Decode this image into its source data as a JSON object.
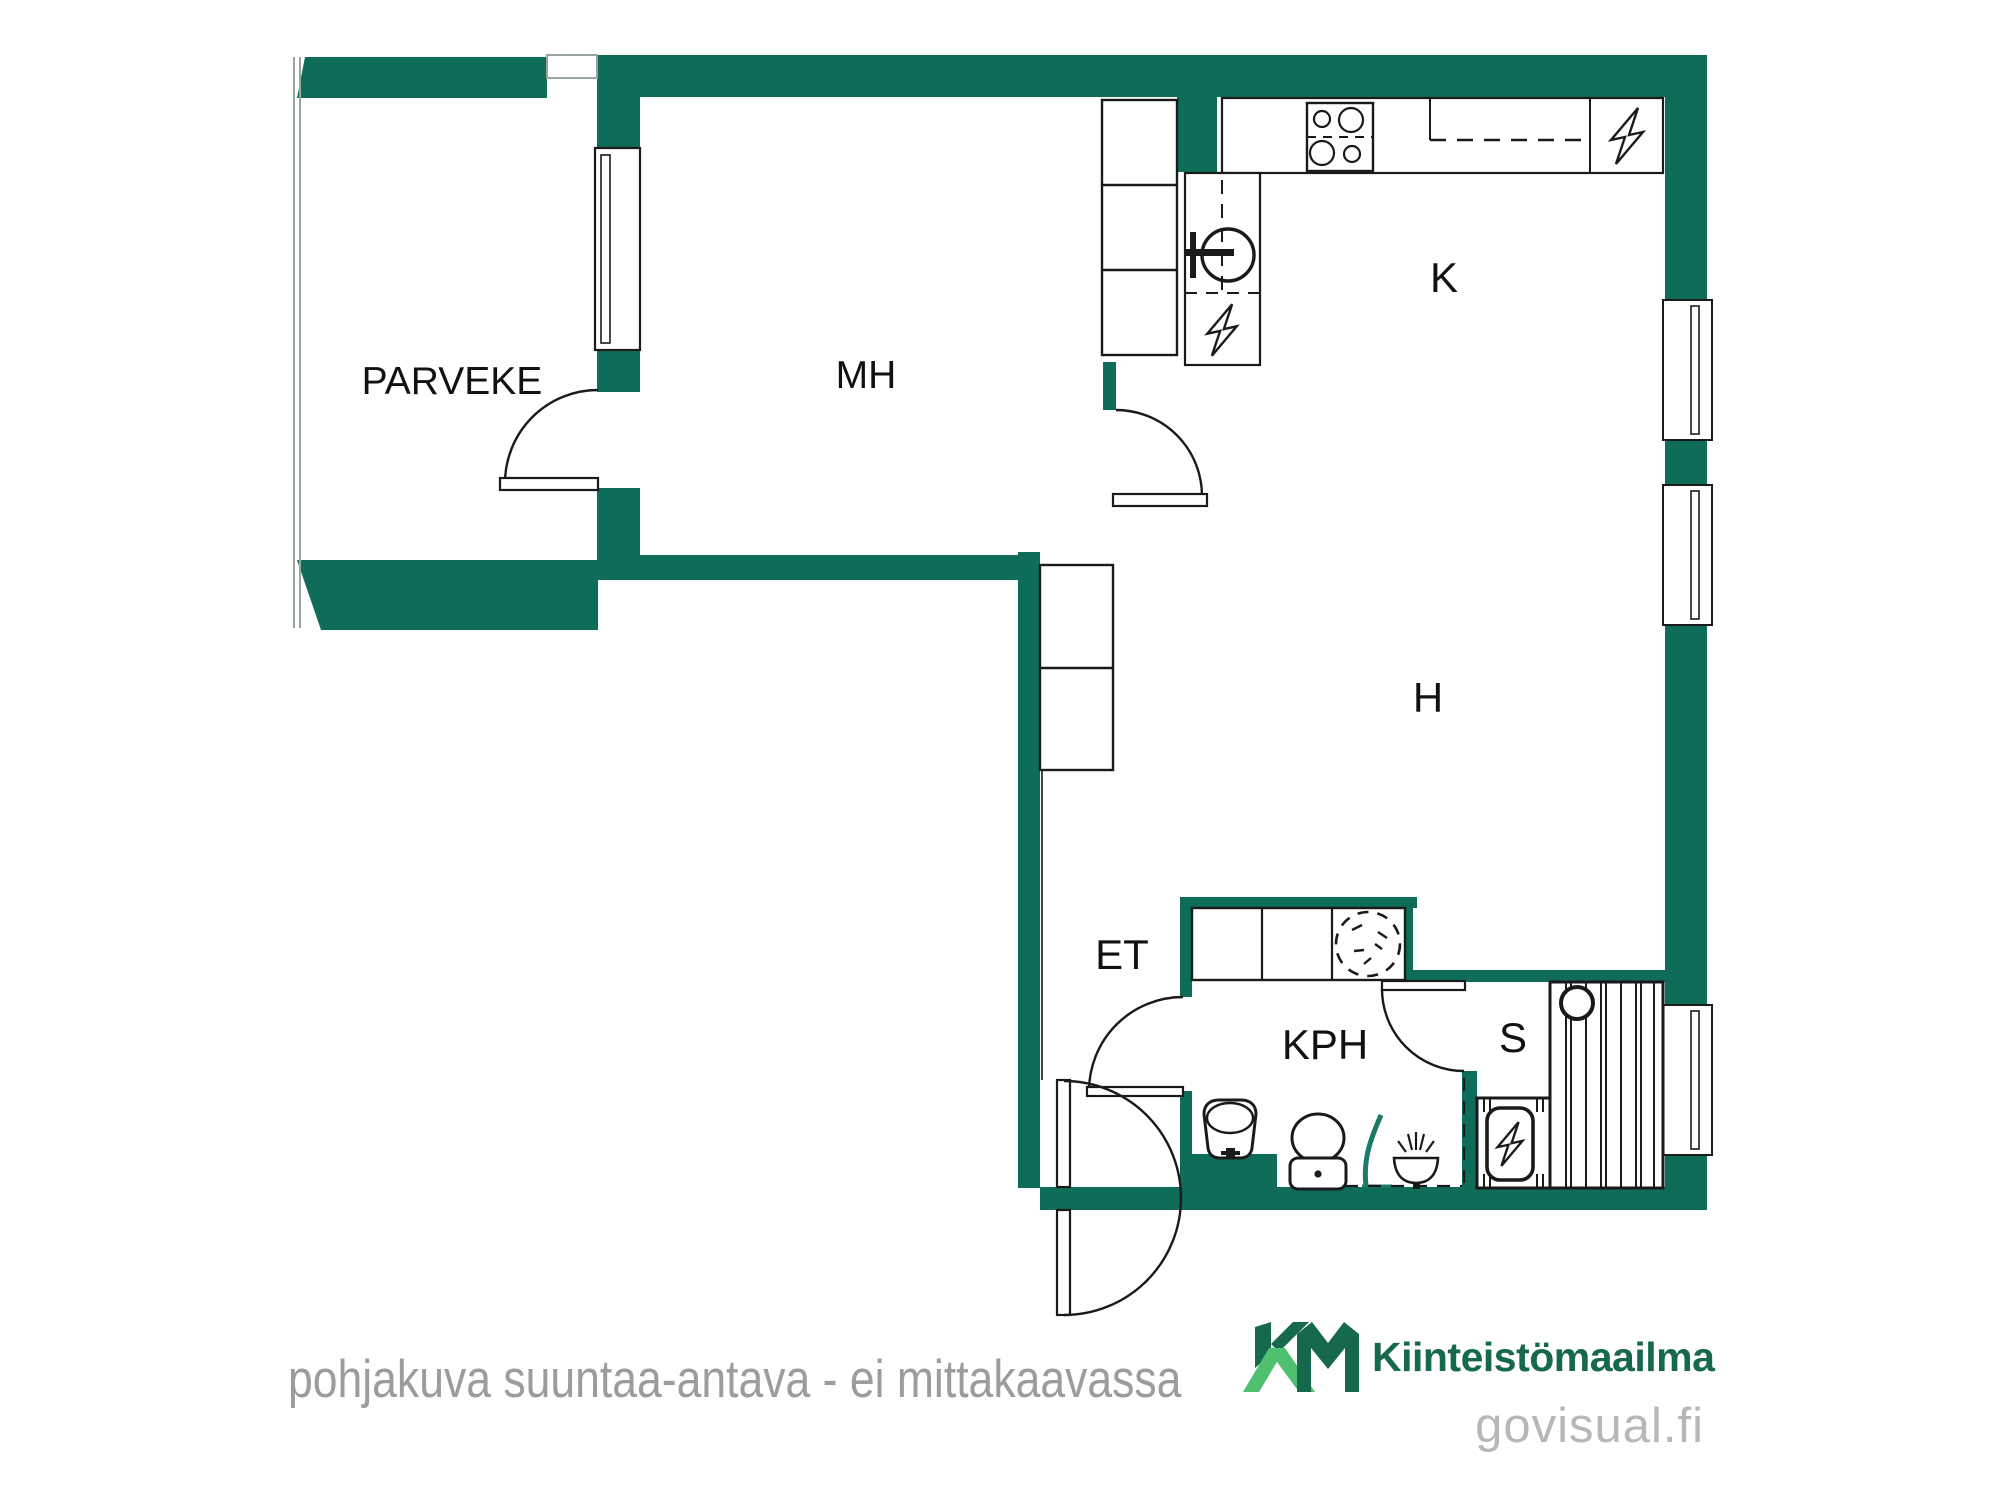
{
  "rooms": {
    "balcony": "PARVEKE",
    "bedroom": "MH",
    "kitchen": "K",
    "living": "H",
    "entrance": "ET",
    "bathroom": "KPH",
    "sauna": "S"
  },
  "footer": {
    "disclaimer": "pohjakuva suuntaa-antava - ei mittakaavassa",
    "brand": "Kiinteistömaailma",
    "brand_mark": "KM",
    "website": "govisual.fi"
  },
  "colors": {
    "wall_green": "#0e6c58",
    "line_black": "#1a1a1a",
    "shower_teal": "#1d7a67",
    "logo_dark_green": "#17694e",
    "logo_light_green": "#4fc06f",
    "disclaimer_gray": "#9c9c9c",
    "website_gray": "#b5b7b9"
  },
  "icons": {
    "kitchen": [
      "stove-icon",
      "sink-icon",
      "dishwasher-icon",
      "refrigerator-icon"
    ],
    "bathroom": [
      "washing-machine-icon",
      "washbasin-icon",
      "toilet-icon",
      "shower-curtain-icon",
      "floor-drain-icon"
    ],
    "sauna": [
      "sauna-heater-icon",
      "sauna-light-icon",
      "sauna-bench"
    ]
  }
}
